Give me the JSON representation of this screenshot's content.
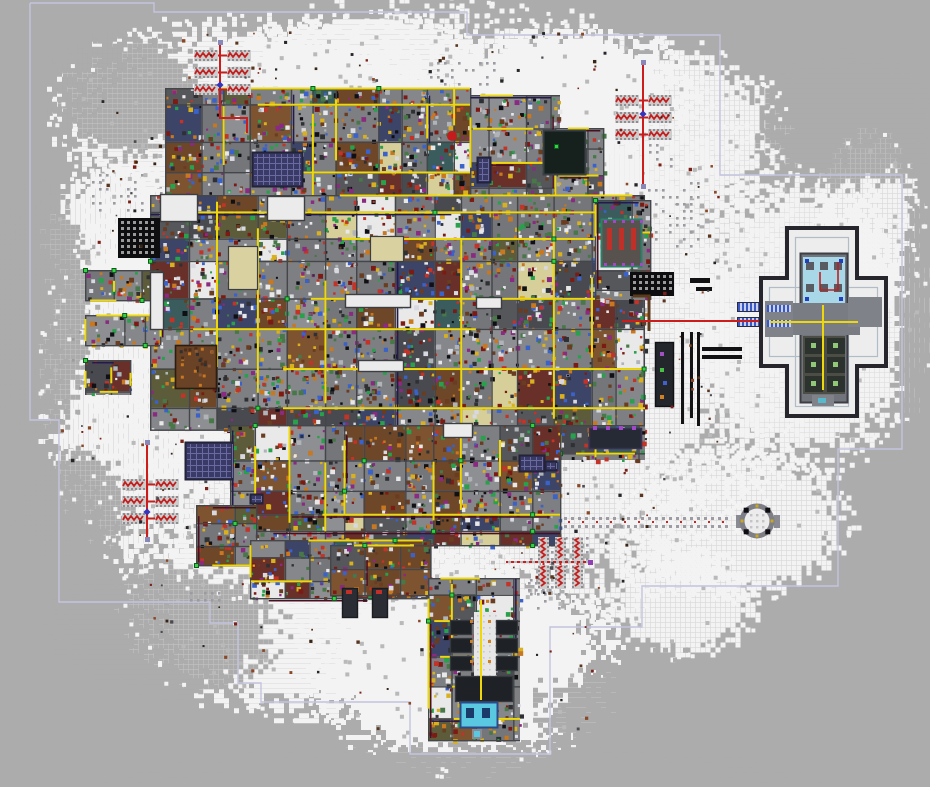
{
  "scene": {
    "w": 930,
    "h": 787,
    "seed": 1337,
    "bg": "#acacac",
    "bg_dot": "#b9b9b9"
  },
  "boundary": {
    "color": "#c4c4de",
    "width": 1.4,
    "points": [
      [
        30,
        3
      ],
      [
        154,
        3
      ],
      [
        154,
        12
      ],
      [
        467,
        12
      ],
      [
        467,
        35
      ],
      [
        720,
        35
      ],
      [
        720,
        175
      ],
      [
        902,
        175
      ],
      [
        902,
        449
      ],
      [
        838,
        449
      ],
      [
        838,
        586
      ],
      [
        642,
        586
      ],
      [
        642,
        627
      ],
      [
        550,
        627
      ],
      [
        550,
        754
      ],
      [
        410,
        754
      ],
      [
        410,
        702
      ],
      [
        261,
        702
      ],
      [
        261,
        683
      ],
      [
        238,
        683
      ],
      [
        238,
        623
      ],
      [
        210,
        623
      ],
      [
        210,
        602
      ],
      [
        59,
        602
      ],
      [
        59,
        420
      ],
      [
        30,
        420
      ],
      [
        30,
        3
      ]
    ]
  },
  "snow": {
    "white": "#f3f3f3",
    "mid": "#dedede",
    "blobs": [
      [
        430,
        330,
        330,
        290
      ],
      [
        250,
        120,
        180,
        95
      ],
      [
        640,
        130,
        130,
        85
      ],
      [
        800,
        320,
        115,
        135
      ],
      [
        730,
        520,
        110,
        70
      ],
      [
        460,
        660,
        140,
        100
      ],
      [
        300,
        600,
        160,
        105
      ],
      [
        140,
        380,
        90,
        160
      ],
      [
        560,
        90,
        120,
        60
      ],
      [
        360,
        60,
        120,
        45
      ],
      [
        680,
        600,
        70,
        50
      ],
      [
        120,
        230,
        70,
        60
      ],
      [
        865,
        230,
        50,
        90
      ]
    ],
    "holes": [
      [
        125,
        92,
        72,
        58
      ],
      [
        40,
        310,
        48,
        115
      ],
      [
        165,
        628,
        105,
        62
      ],
      [
        845,
        122,
        85,
        62
      ],
      [
        660,
        712,
        120,
        55
      ],
      [
        70,
        505,
        55,
        55
      ],
      [
        925,
        330,
        30,
        140
      ],
      [
        465,
        792,
        320,
        48
      ]
    ]
  },
  "dot_patches": [
    [
      648,
      182,
      56,
      70,
      0.5
    ],
    [
      160,
      192,
      40,
      18,
      0.75
    ],
    [
      92,
      174,
      56,
      42,
      0.5
    ],
    [
      190,
      592,
      32,
      14,
      0.6
    ],
    [
      628,
      144,
      44,
      34,
      0.4
    ],
    [
      528,
      582,
      26,
      12,
      0.6
    ],
    [
      72,
      282,
      14,
      110,
      0.3
    ],
    [
      530,
      530,
      62,
      84,
      0.3
    ],
    [
      430,
      62,
      70,
      26,
      0.35
    ]
  ],
  "trail": {
    "x1": 508,
    "x2": 732,
    "y_top": 517,
    "y_bot": 525,
    "y_red": 521,
    "dot": "#9c9ca2",
    "red": "#c22828"
  },
  "base": {
    "plates": [
      [
        165,
        88,
        305,
        112
      ],
      [
        470,
        95,
        90,
        105
      ],
      [
        555,
        128,
        48,
        72
      ],
      [
        150,
        195,
        495,
        235
      ],
      [
        595,
        200,
        55,
        100
      ],
      [
        560,
        425,
        85,
        35
      ],
      [
        230,
        425,
        330,
        120
      ],
      [
        196,
        505,
        60,
        60
      ],
      [
        250,
        540,
        180,
        58
      ],
      [
        330,
        545,
        100,
        50
      ],
      [
        428,
        578,
        92,
        162
      ],
      [
        85,
        270,
        75,
        30
      ],
      [
        85,
        315,
        75,
        30
      ],
      [
        85,
        360,
        45,
        35
      ]
    ],
    "floor": "#7e8082",
    "wall": "#44464a",
    "floors": [
      "#7d7f82",
      "#85878a",
      "#74767a",
      "#8d8f92",
      "#55575b",
      "#484a50",
      "#d6cf9a",
      "#6e4628",
      "#7d5330",
      "#e9e9e9",
      "#69302a",
      "#3c4468",
      "#5d5c3a",
      "#3a5c5c"
    ],
    "fw": [
      18,
      14,
      12,
      10,
      6,
      5,
      6,
      5,
      4,
      4,
      4,
      4,
      4,
      4
    ],
    "items": [
      "#2e3033",
      "#c23328",
      "#d8b020",
      "#3a62c8",
      "#28a04c",
      "#c87820",
      "#8a2a80",
      "#e8e8e8",
      "#101014",
      "#6a3c20",
      "#b0b4b8",
      "#487848",
      "#d8d8e0",
      "#7c1a14"
    ],
    "conduit": "#eed70a",
    "dark_lines": [
      "#4a1022",
      "#241a50"
    ],
    "node_in": "#34d144",
    "node_out": "#0c5c1c"
  },
  "rooms": {
    "white": [
      [
        267,
        196,
        38,
        25
      ],
      [
        160,
        194,
        38,
        28
      ],
      [
        150,
        272,
        14,
        58
      ],
      [
        345,
        294,
        66,
        14
      ],
      [
        358,
        360,
        46,
        12
      ],
      [
        476,
        297,
        26,
        12
      ],
      [
        443,
        423,
        30,
        15
      ]
    ],
    "pale": [
      [
        228,
        246,
        30,
        44
      ],
      [
        370,
        236,
        34,
        26
      ]
    ],
    "brown": [
      175,
      345,
      42,
      44
    ],
    "white_fill": "#ebebeb",
    "pale_fill": "#d9d2a0",
    "brown_fill": "#6a4226",
    "border": "#3c3e42"
  },
  "features": {
    "solar": {
      "rects": [
        [
          252,
          152,
          51,
          35
        ],
        [
          185,
          442,
          48,
          38
        ],
        [
          477,
          157,
          14,
          26
        ],
        [
          519,
          455,
          26,
          17
        ],
        [
          250,
          494,
          13,
          10
        ],
        [
          545,
          461,
          12,
          10
        ]
      ],
      "fill": "#3a3a66",
      "border": "#23233a",
      "grid": "#6a6aa0"
    },
    "waffles": {
      "rects": [
        [
          118,
          218,
          42,
          40
        ],
        [
          630,
          272,
          44,
          24
        ]
      ],
      "fill": "#0e0e10",
      "hole": "#9a9a9a"
    },
    "dark_square": {
      "rect": [
        543,
        130,
        43,
        45
      ],
      "fill": "#16201c",
      "border": "#3a3f44",
      "node": [
        556,
        146
      ]
    },
    "red_room": {
      "rect": [
        601,
        219,
        41,
        48
      ],
      "fill": "#57524e",
      "border": "#2a8068",
      "bars": "#c03028",
      "purple": "#a048c8"
    },
    "bars": {
      "rects": [
        [
          681,
          332,
          3,
          92
        ],
        [
          690,
          332,
          3,
          86
        ],
        [
          697,
          332,
          3,
          94
        ],
        [
          702,
          347,
          40,
          4
        ],
        [
          702,
          355,
          40,
          4
        ],
        [
          690,
          278,
          20,
          5
        ],
        [
          696,
          287,
          16,
          4
        ]
      ],
      "fill": "#121214"
    },
    "dark_column": {
      "rect": [
        655,
        342,
        19,
        65
      ],
      "fill": "#23262b",
      "dots": [
        [
          "#a050c0",
          660,
          352
        ],
        [
          "#48c048",
          660,
          368
        ],
        [
          "#4060d0",
          663,
          381
        ],
        [
          "#d08020",
          660,
          395
        ]
      ]
    },
    "purple_room": {
      "rect": [
        589,
        428,
        53,
        21
      ],
      "fill": "#262a34",
      "border": "#3a3055",
      "dot": "#a048c8"
    },
    "brown_line": {
      "pts": [
        [
          633,
          296
        ],
        [
          649,
          296
        ],
        [
          649,
          331
        ]
      ],
      "color": "#5a3a1a"
    },
    "blue_tabs": {
      "rects": [
        [
          738,
          303,
          24,
          8
        ],
        [
          738,
          318,
          24,
          8
        ]
      ],
      "a": "#3858c8",
      "b": "#c8d0ea",
      "border": "#2a2a40"
    },
    "strip": {
      "corridor": [
        474,
        612,
        22,
        64
      ],
      "corridor_fill": "#e6e6e6",
      "rooms": [
        [
          450,
          620,
          22,
          15
        ],
        [
          450,
          638,
          22,
          15
        ],
        [
          450,
          656,
          22,
          15
        ],
        [
          496,
          620,
          22,
          15
        ],
        [
          496,
          638,
          22,
          15
        ],
        [
          496,
          656,
          22,
          15
        ],
        [
          455,
          676,
          58,
          26
        ]
      ],
      "room_fill": "#1e2226",
      "room_border": "#35393e",
      "conduit_x": 480,
      "conduit_y1": 600,
      "conduit_y2": 700,
      "orange": "#d08020"
    },
    "pool": {
      "rect": [
        460,
        702,
        38,
        26
      ],
      "fill": "#5ac8e0",
      "border": "#2a4a8a",
      "blocks": [
        [
          466,
          708,
          8,
          10
        ],
        [
          482,
          708,
          8,
          10
        ]
      ],
      "block_fill": "#1a3a6a",
      "stem": [
        472,
        729,
        10,
        10
      ],
      "stem_dot": [
        474,
        731,
        6,
        6
      ]
    },
    "legs": {
      "rects": [
        [
          342,
          588,
          16,
          30
        ],
        [
          372,
          588,
          16,
          30
        ]
      ],
      "fill": "#2a2e34",
      "border": "#191c20",
      "red": "#c03028"
    },
    "clusters": [
      {
        "pos": [
          194,
          50
        ],
        "o": "h"
      },
      {
        "pos": [
          615,
          95
        ],
        "o": "h"
      },
      {
        "pos": [
          122,
          479
        ],
        "o": "h"
      },
      {
        "pos": [
          538,
          537
        ],
        "o": "v"
      }
    ],
    "cluster_style": {
      "pad": "#cdcdcd",
      "stud": "#8e8e92",
      "red": "#c32020"
    },
    "red_lines": [
      {
        "pts": [
          [
            220,
            42
          ],
          [
            220,
            118
          ],
          [
            247,
            118
          ],
          [
            247,
            133
          ]
        ],
        "dots": [
          [
            220,
            42
          ]
        ],
        "diamond": [
          220,
          85
        ]
      },
      {
        "pts": [
          [
            643,
            62
          ],
          [
            643,
            186
          ]
        ],
        "dots": [
          [
            643,
            62
          ],
          [
            643,
            186
          ]
        ],
        "diamond": [
          643,
          114
        ]
      },
      {
        "pts": [
          [
            147,
            442
          ],
          [
            147,
            539
          ]
        ],
        "dots": [
          [
            147,
            442
          ],
          [
            147,
            539
          ]
        ],
        "diamond": [
          147,
          512
        ]
      },
      {
        "pts": [
          [
            506,
            562
          ],
          [
            590,
            562
          ]
        ],
        "dots": [],
        "pdots": [
          [
            590,
            562
          ]
        ],
        "dash": true
      },
      {
        "pts": [
          [
            622,
            321
          ],
          [
            813,
            321
          ]
        ],
        "dots": []
      }
    ],
    "line_style": {
      "red": "#cc1c1c",
      "dot": "#8888b8",
      "diamond": "#3434bc",
      "dash": "#b8b8bc",
      "purple": "#9040b0"
    },
    "compound": {
      "wallV": [
        789,
        230,
        66,
        184
      ],
      "wallH": [
        763,
        280,
        121,
        84
      ],
      "wall_color": "#26262c",
      "court": "#ededed",
      "inner_wall": "#b2bcc6",
      "core": [
        800,
        253,
        48,
        150
      ],
      "core_fill": "#72747c",
      "core_border": "#3c3e44",
      "top_room": [
        803,
        257,
        42,
        46
      ],
      "top_fill": "#a8d8e8",
      "machine": "#585c62",
      "blue_dot": "#2040c0",
      "red_cable": [
        [
          838,
          262
        ],
        [
          838,
          290
        ],
        [
          820,
          290
        ],
        [
          820,
          272
        ]
      ],
      "mid_band": [
        790,
        303,
        70,
        32
      ],
      "mid_fill": "#7a7c84",
      "low_rooms": [
        803,
        336,
        42,
        58
      ],
      "low_fill": "#4c4e46",
      "cell_fill": "#2c322e",
      "cell_dot": "#90c878",
      "left_tab": [
        765,
        301,
        28,
        36
      ],
      "right_tab": [
        848,
        297,
        34,
        30
      ],
      "tab_fill": "#80828a",
      "hatches": [
        [
          767,
          305,
          22,
          7
        ],
        [
          767,
          320,
          22,
          7
        ]
      ],
      "yellow_h": [
        770,
        321,
        88
      ],
      "yellow_v": [
        822,
        305,
        85
      ],
      "bottom_bit": [
        812,
        395,
        22,
        11
      ],
      "bottom_dot": [
        818,
        398,
        8,
        5
      ],
      "cyan": "#58b8cc"
    },
    "circle": {
      "cx": 757,
      "cy": 521,
      "r": 15,
      "ring": "#7e7e86",
      "inner": "#ececec",
      "dots": "#c4c4c8",
      "studs": "#0e0e12",
      "pips": "#c8a820",
      "tabs": [
        [
          736,
          515,
          6,
          13
        ],
        [
          774,
          515,
          6,
          13
        ]
      ],
      "tab_fill": "#8a8a92"
    },
    "small_dots": [
      [
        452,
        136,
        5,
        "#c41c1c"
      ]
    ]
  },
  "debris": {
    "n": 900,
    "colors": [
      "#5a3620",
      "#7a2018",
      "#26262a",
      "#4a4a50",
      "#8a4828",
      "#3a2414"
    ]
  },
  "hotspots": [
    {
      "name": "colony-base",
      "rect": [
        150,
        85,
        500,
        460
      ]
    },
    {
      "name": "ancient-compound",
      "rect": [
        762,
        226,
        122,
        190
      ]
    },
    {
      "name": "trap-cluster-northwest",
      "rect": [
        192,
        42,
        62,
        62
      ]
    },
    {
      "name": "trap-cluster-northeast",
      "rect": [
        613,
        90,
        60,
        58
      ]
    },
    {
      "name": "trap-cluster-west",
      "rect": [
        119,
        475,
        62,
        58
      ]
    },
    {
      "name": "trap-cluster-south",
      "rect": [
        534,
        533,
        54,
        60
      ]
    },
    {
      "name": "ruin-circle",
      "rect": [
        735,
        499,
        46,
        44
      ]
    },
    {
      "name": "power-plant-strip",
      "rect": [
        428,
        578,
        95,
        165
      ]
    },
    {
      "name": "solar-array-north",
      "rect": [
        252,
        150,
        52,
        38
      ]
    },
    {
      "name": "solar-array-west",
      "rect": [
        185,
        441,
        50,
        40
      ]
    }
  ]
}
